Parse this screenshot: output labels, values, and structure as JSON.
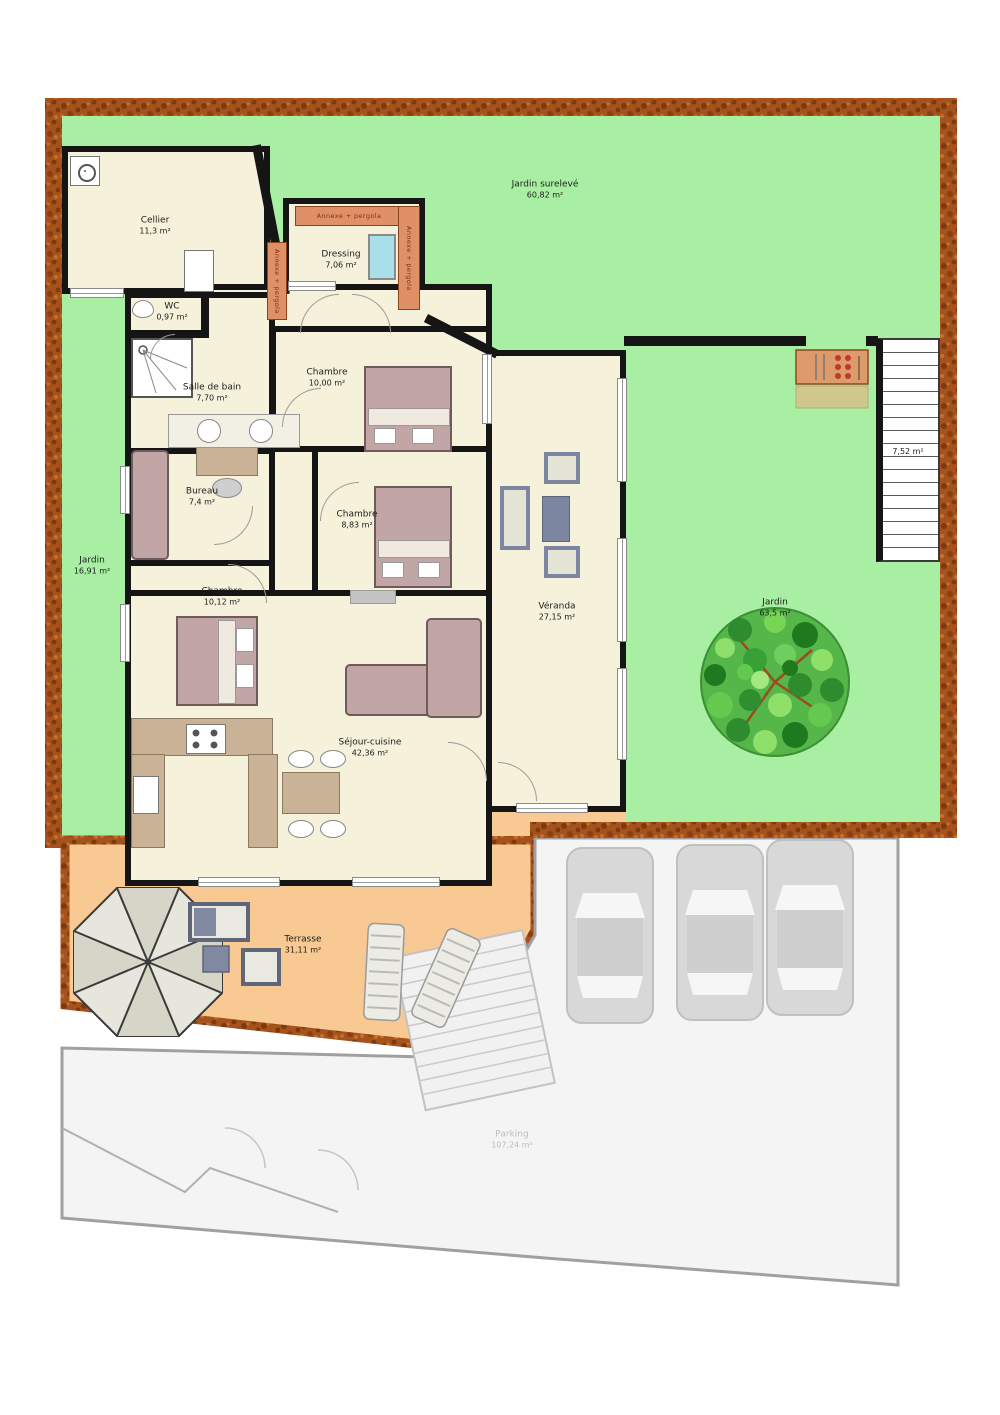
{
  "rooms": {
    "cellier": {
      "name": "Cellier",
      "area": "11,3 m²"
    },
    "dressing": {
      "name": "Dressing",
      "area": "7,06 m²"
    },
    "wc": {
      "name": "WC",
      "area": "0,97 m²"
    },
    "salle_de_bain": {
      "name": "Salle de bain",
      "area": "7,70 m²"
    },
    "chambre_1": {
      "name": "Chambre",
      "area": "10,00 m²"
    },
    "chambre_2": {
      "name": "Chambre",
      "area": "8,83 m²"
    },
    "chambre_3": {
      "name": "Chambre",
      "area": "10,12 m²"
    },
    "bureau": {
      "name": "Bureau",
      "area": "7,4 m²"
    },
    "veranda": {
      "name": "Véranda",
      "area": "27,15 m²"
    },
    "sejour_cuisine": {
      "name": "Séjour-cuisine",
      "area": "42,36 m²"
    }
  },
  "outdoor": {
    "jardin_sureleve": {
      "name": "Jardin surelevé",
      "area": "60,82 m²"
    },
    "jardin_ouest": {
      "name": "Jardin",
      "area": "16,91 m²"
    },
    "jardin_est": {
      "name": "Jardin",
      "area": "63,5 m²"
    },
    "terrasse": {
      "name": "Terrasse",
      "area": "31,11 m²"
    },
    "parking": {
      "name": "Parking",
      "area": "107,24 m²"
    },
    "escalier": {
      "area": "7,52 m²"
    },
    "annexe_pergola": {
      "label": "Annexe + pergola"
    }
  },
  "palette": {
    "garden_green": "#a9efa3",
    "house_floor": "#f6f1db",
    "wall_black": "#151515",
    "terrace_orange": "#f8c992",
    "hedge_brown": "#a5521d",
    "pergola_orange": "#e09067",
    "parking_grey": "#f4f4f4",
    "car_grey": "#d8d8d8",
    "furniture_mauve": "#c2a6a6",
    "kitchen_tan": "#c9b295",
    "dressing_window_blue": "#a9dfe8",
    "tree_green": "#55b649"
  }
}
